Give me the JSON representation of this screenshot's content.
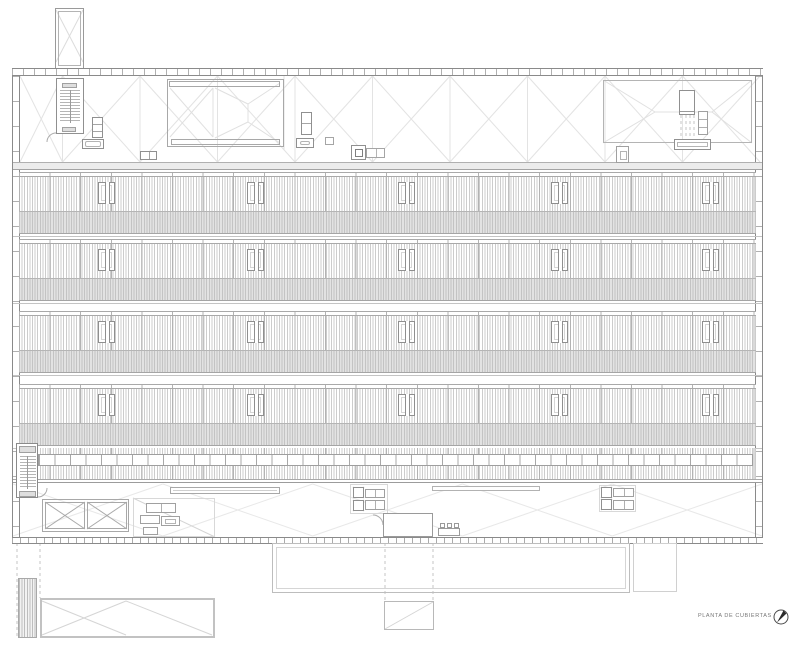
{
  "title_block": {
    "title": "PLANTA DE CUBIERTAS"
  },
  "icons": {
    "north_arrow": "north-arrow-icon"
  },
  "colors": {
    "background": "#ffffff",
    "wall_line": "#8a8a8a",
    "detail_line": "#9a9a9a",
    "hatch_line": "#cccccc",
    "panel_joint_line": "#b3b3b3",
    "gray_band_fill": "#e2e2e2",
    "gray_band_line": "#c3c3c3",
    "faint_roof_line": "#e3e3e3",
    "title_text": "#777777",
    "north_needle": "#2a2a2a"
  },
  "plan": {
    "hatch_bands": {
      "count": 4,
      "ys": [
        172,
        239,
        311,
        384
      ],
      "x": 19,
      "w": 737,
      "tick_h": 5,
      "hatch_h": 34,
      "gray_h": 23,
      "skylight_xs": [
        98,
        247,
        398,
        551,
        702
      ],
      "skylights_per_band": 5,
      "skylight_dy": 10,
      "skylight_w": 17,
      "skylight_h": 22
    },
    "clerestory_strip": {
      "x": 38,
      "y": 454,
      "w": 715,
      "h": 12,
      "cell_w": 15.5
    },
    "top_roof_pattern": {
      "x_start": 62.5,
      "step": 77.5,
      "lines": 9,
      "y1": 76,
      "y2": 162,
      "mid_y": 119,
      "left": 20,
      "right": 760
    },
    "lower_roof_pattern": {
      "x_start": 13,
      "step": 149.8,
      "bays": 5,
      "y1": 484,
      "y2": 536,
      "mid_y": 510
    }
  }
}
